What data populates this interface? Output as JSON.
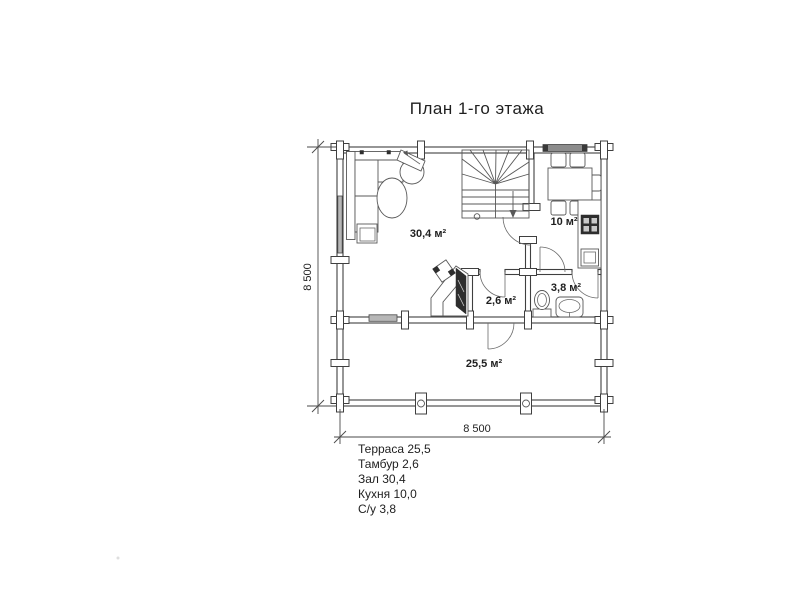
{
  "title": "План 1-го этажа",
  "rooms": {
    "zal": "30,4 м²",
    "kitchen": "10 м²",
    "tambour": "2,6 м²",
    "bathroom": "3,8 м²",
    "terrace": "25,5 м²"
  },
  "dimensions": {
    "width": "8 500",
    "height": "8 500"
  },
  "legend": [
    "Терраса 25,5",
    "Тамбур 2,6",
    "Зал 30,4",
    "Кухня 10,0",
    "С/у 3,8"
  ],
  "colors": {
    "wall_line": "#3f3f3f",
    "furniture_line": "#585858",
    "window_fill": "#b7b7b7",
    "dark_fill": "#2e2e2e",
    "text": "#1f1f1f"
  }
}
